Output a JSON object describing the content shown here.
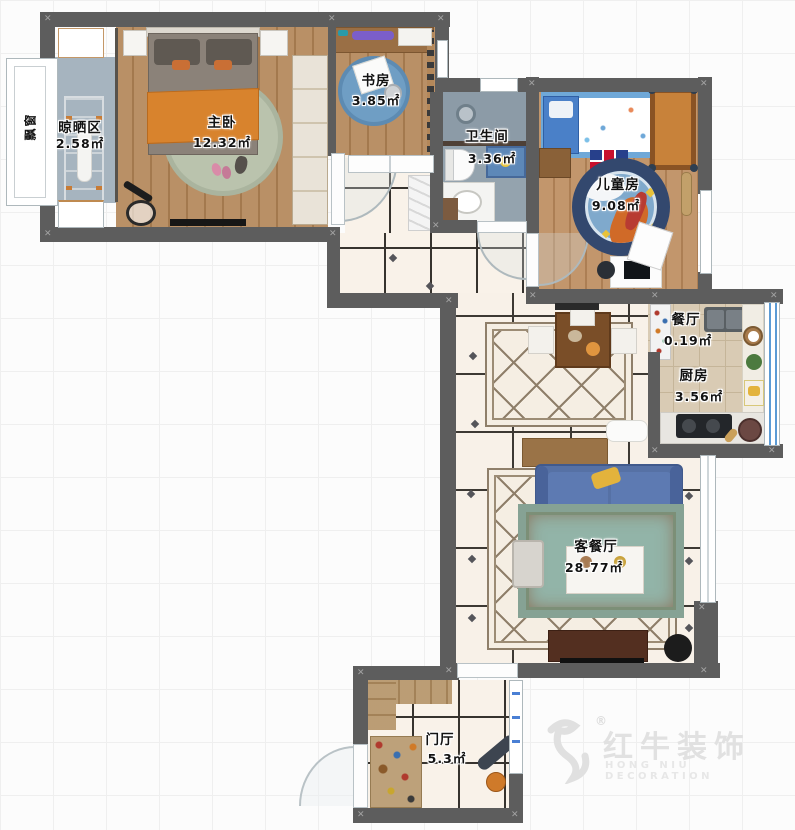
{
  "plan": {
    "type": "apartment-floor-plan",
    "rooms": [
      {
        "name": "晾晒区",
        "area": "2.58㎡"
      },
      {
        "name": "主卧",
        "area": "12.32㎡"
      },
      {
        "name": "书房",
        "area": "3.85㎡"
      },
      {
        "name": "卫生间",
        "area": "3.36㎡"
      },
      {
        "name": "儿童房",
        "area": "9.08㎡"
      },
      {
        "name": "餐厅",
        "area": "0.19㎡"
      },
      {
        "name": "厨房",
        "area": "3.56㎡"
      },
      {
        "name": "客餐厅",
        "area": "28.77㎡"
      },
      {
        "name": "门厅",
        "area": "5.3㎡"
      }
    ],
    "annotations": {
      "bay_window": "飘窗",
      "kids_rug_text": "PATROL"
    },
    "watermark": {
      "brand": "红牛装饰",
      "subtitle": "HONG NIU DECORATION",
      "registered": "®"
    },
    "colors": {
      "wall": "#5d5d5d",
      "wood_floor": "#b4885a",
      "tile_floor": "#f8f1e8",
      "bath_floor": "#94a3ae",
      "kitchen_floor": "#d9cbb4",
      "sofa_blue": "#5671a5",
      "rug_teal": "#92b4a8",
      "kids_rug_blue": "#7fa9cc",
      "kids_bed_orange": "#c8823a",
      "blanket_orange": "#d8832d"
    }
  }
}
